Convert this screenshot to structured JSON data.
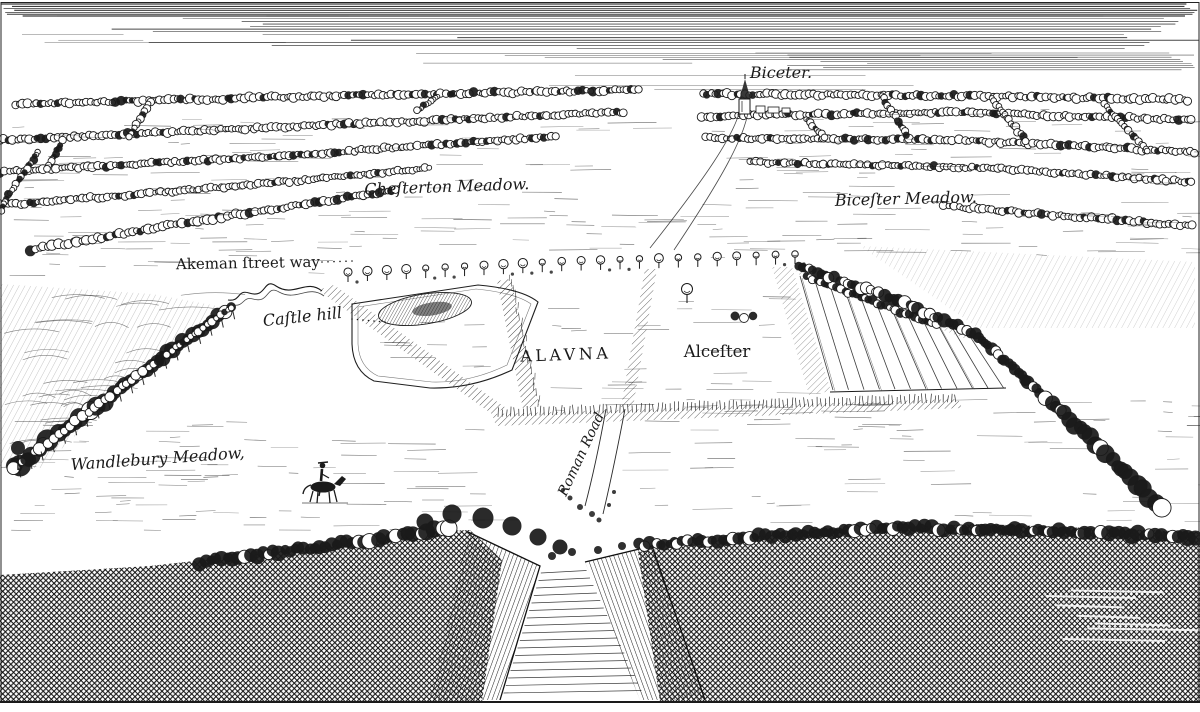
{
  "engraving": {
    "labels": {
      "bicester_town": "Biceter.",
      "chesterton_meadow": "Cheſterton Meadow.",
      "bicester_meadow": "Biceſter Meadow.",
      "akeman_street_way": "Akeman ſtreet way",
      "castle_hill": "Caſtle hill",
      "alauna": "ALAVNA",
      "alcester": "Alceſter",
      "wandlebury_meadow": "Wandlebury Meadow,",
      "roman_road": "Roman Road"
    },
    "palette": {
      "ink": "#1a1a1a",
      "paper": "#ffffff"
    }
  }
}
